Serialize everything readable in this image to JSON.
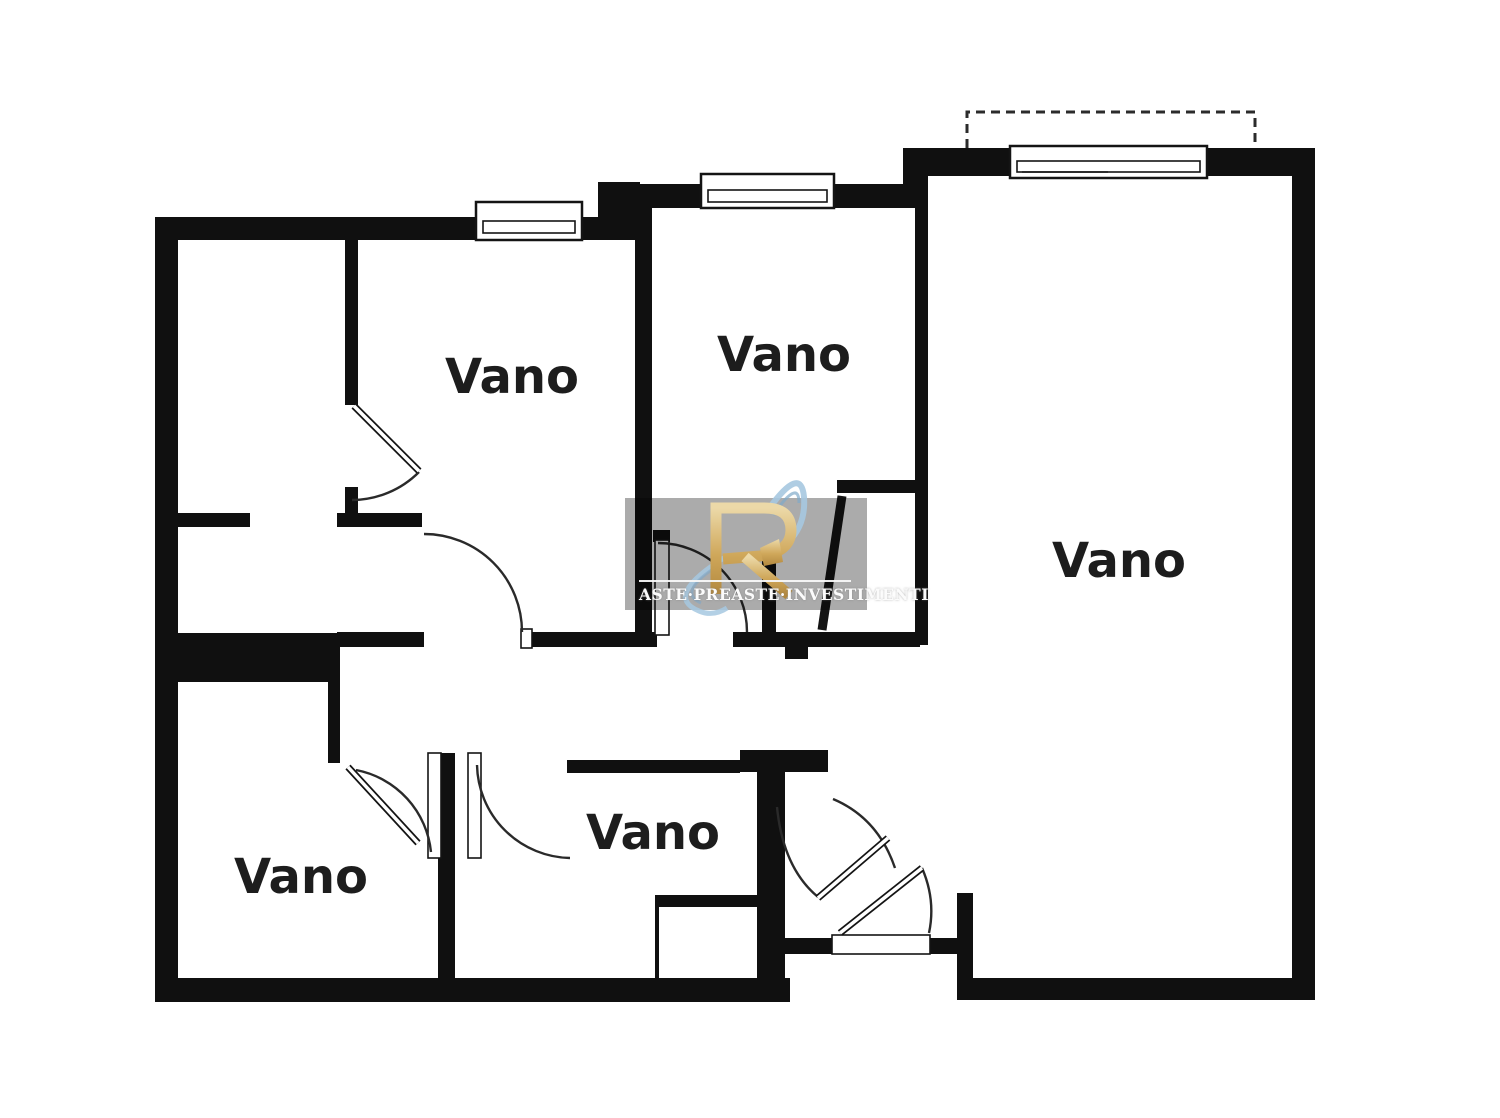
{
  "page": {
    "background": "#ffffff"
  },
  "floor_plan": {
    "type": "apartment-floor-plan",
    "wall_color": "#101010",
    "rooms": [
      {
        "id": "room-top-left",
        "label": "Vano"
      },
      {
        "id": "room-top-middle",
        "label": "Vano"
      },
      {
        "id": "room-right-large",
        "label": "Vano"
      },
      {
        "id": "room-bottom-left",
        "label": "Vano"
      },
      {
        "id": "room-bottom-middle",
        "label": "Vano"
      }
    ],
    "icons": {
      "window_icon": "double-line window symbol in wall",
      "door_swing_icon": "quarter-circle door swing arc",
      "balcony_outline_icon": "dashed rectangle outline"
    }
  },
  "watermark": {
    "caption": "ASTE·PREASTE·INVESTIMENTI",
    "logo_letter": "R",
    "panel_color": "#ababab",
    "gold_color": "#cfa75a",
    "blue_color": "#a6c8e0",
    "text_color": "#fbfbfb"
  }
}
